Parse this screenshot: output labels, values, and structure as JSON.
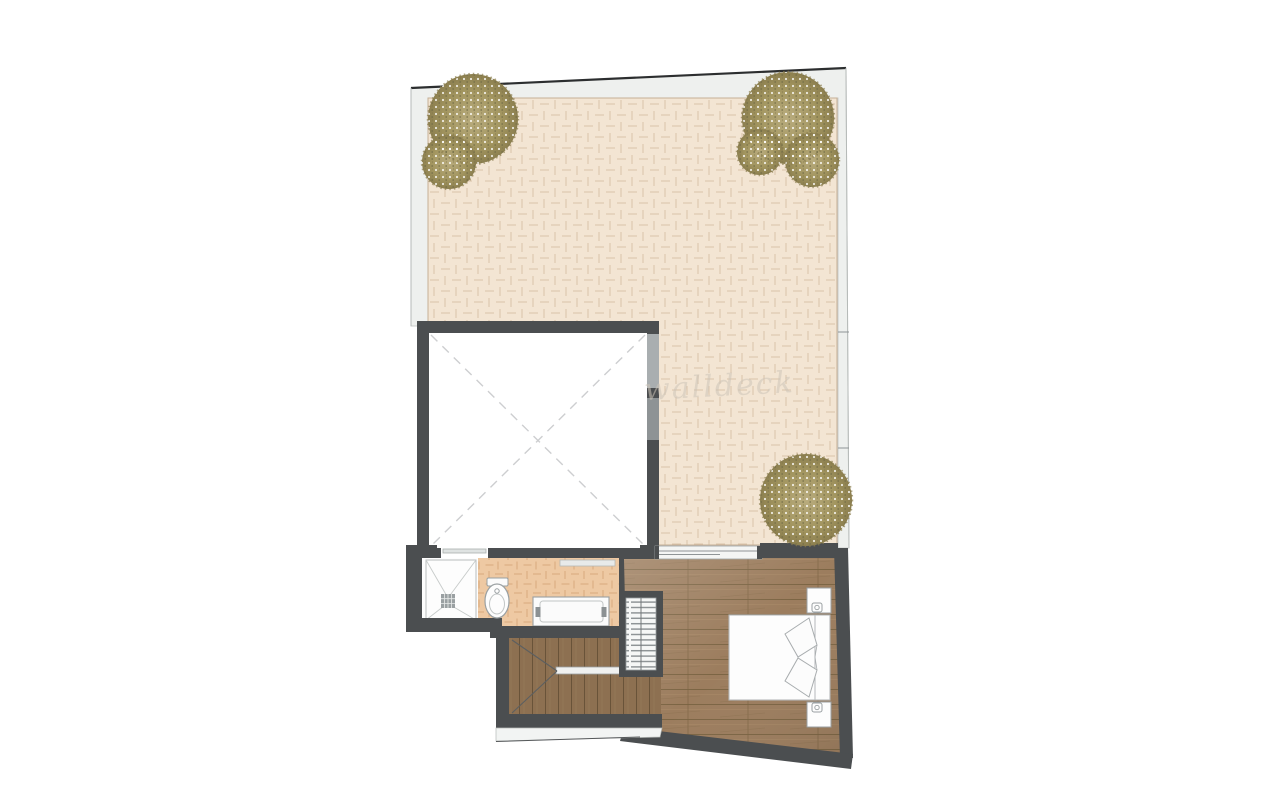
{
  "document": {
    "kind": "architectural floor plan, top-down view",
    "background": "#ffffff"
  },
  "watermark": {
    "text": "walldeck"
  },
  "palette": {
    "wall": "#4b4e50",
    "outer_band": "#eef0ee",
    "terrace_tile": "#f3e5d3",
    "terrace_grout": "#d9c2a9",
    "bathroom_tile": "#eec9a3",
    "bathroom_grout": "#d8a97d",
    "bedroom_wood": "#9c7d5e",
    "stair_wood": "#8d7051",
    "foliage": "#a2955f",
    "fixture_outline": "#9aa0a2",
    "void_cross_dash": "#cdced0"
  },
  "elements": {
    "terrace": {
      "floor": "herringbone paving",
      "tree_clusters": [
        "top-left",
        "top-right",
        "middle-right"
      ]
    },
    "void_room": {
      "marking": "dashed diagonal cross",
      "window": "right wall"
    },
    "bathroom": {
      "fixtures": [
        "walk-in shower with drain",
        "toilet",
        "vanity basin"
      ]
    },
    "staircase": {
      "material": "wood treads",
      "rail": "landing rail"
    },
    "bedroom": {
      "floor": "wood planks",
      "furniture": [
        "double bed with pillows",
        "nightstand upper with lamp",
        "nightstand lower with lamp",
        "wardrobe with hanging rail",
        "sliding glass door to terrace"
      ]
    }
  }
}
